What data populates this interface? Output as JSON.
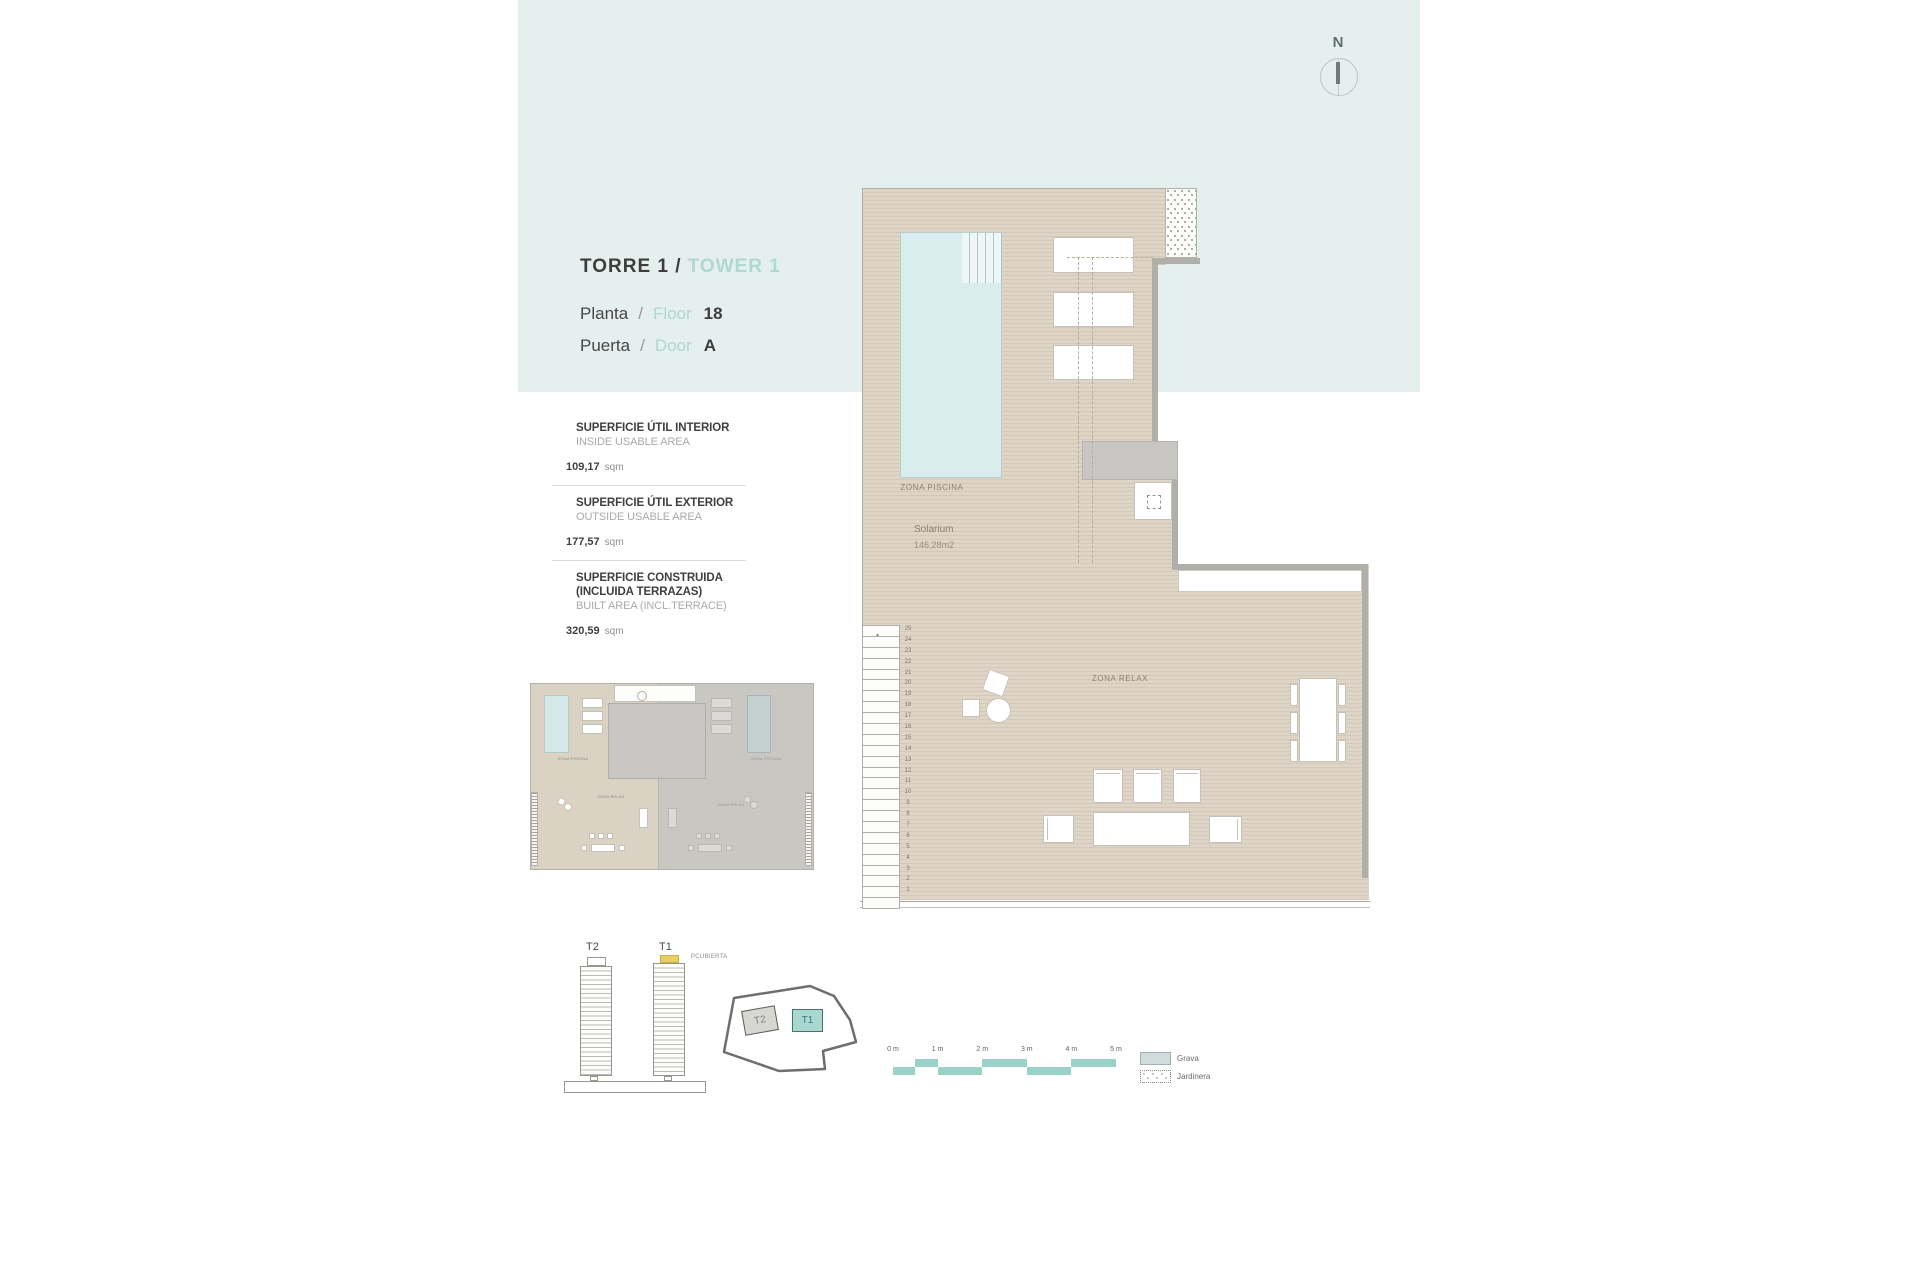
{
  "header": {
    "torre": "TORRE 1 /",
    "tower": "TOWER 1",
    "planta": "Planta",
    "slash": "/",
    "floor_word": "Floor",
    "floor_value": "18",
    "puerta": "Puerta",
    "door_word": "Door",
    "door_value": "A"
  },
  "areas": {
    "sections": [
      {
        "title_lines": [
          "SUPERFICIE ÚTIL INTERIOR"
        ],
        "subtitle": "INSIDE USABLE AREA",
        "value": "109,17",
        "unit": "sqm"
      },
      {
        "title_lines": [
          "SUPERFICIE ÚTIL EXTERIOR"
        ],
        "subtitle": "OUTSIDE USABLE AREA",
        "value": "177,57",
        "unit": "sqm"
      },
      {
        "title_lines": [
          "SUPERFICIE CONSTRUIDA",
          "(INCLUIDA TERRAZAS)"
        ],
        "subtitle": "BUILT AREA (INCL.TERRACE)",
        "value": "320,59",
        "unit": "sqm"
      }
    ]
  },
  "plan": {
    "zona_piscina": "ZONA PISCINA",
    "solarium": "Solarium",
    "solarium_area": "146,28m2",
    "zona_relax": "ZONA RELAX",
    "ruler_arrow": "▲",
    "ruler_numbers": [
      25,
      24,
      23,
      22,
      21,
      20,
      19,
      18,
      17,
      16,
      15,
      14,
      13,
      12,
      11,
      10,
      9,
      8,
      7,
      6,
      5,
      4,
      3,
      2,
      1
    ]
  },
  "towers": {
    "t2": "T2",
    "t1": "T1",
    "pcubierta": "PCUBIERTA"
  },
  "compass": {
    "label": "N"
  },
  "scalebar": {
    "labels": [
      "0 m",
      "1 m",
      "2 m",
      "3 m",
      "4 m",
      "5 m"
    ],
    "meters_total": 5,
    "blocks": [
      {
        "from": 0,
        "to": 0.5,
        "row": "bottom"
      },
      {
        "from": 0.5,
        "to": 1,
        "row": "top"
      },
      {
        "from": 1,
        "to": 2,
        "row": "bottom"
      },
      {
        "from": 2,
        "to": 3,
        "row": "top"
      },
      {
        "from": 3,
        "to": 4,
        "row": "bottom"
      },
      {
        "from": 4,
        "to": 5,
        "row": "top"
      }
    ]
  },
  "legend": {
    "items": [
      {
        "label": "Grava",
        "swatch": "grava"
      },
      {
        "label": "Jardinera",
        "swatch": "jardinera"
      }
    ]
  },
  "colors": {
    "accent_teal_text": "#aed8d4",
    "scalebar_teal": "#9ad2ca",
    "highlight_yellow": "#e9d05e",
    "t1_site_fill": "#a9d7d1",
    "deck_beige": "#ddd4c5",
    "pool_blue": "#d9ecee",
    "band_blue": "#e4efee"
  }
}
